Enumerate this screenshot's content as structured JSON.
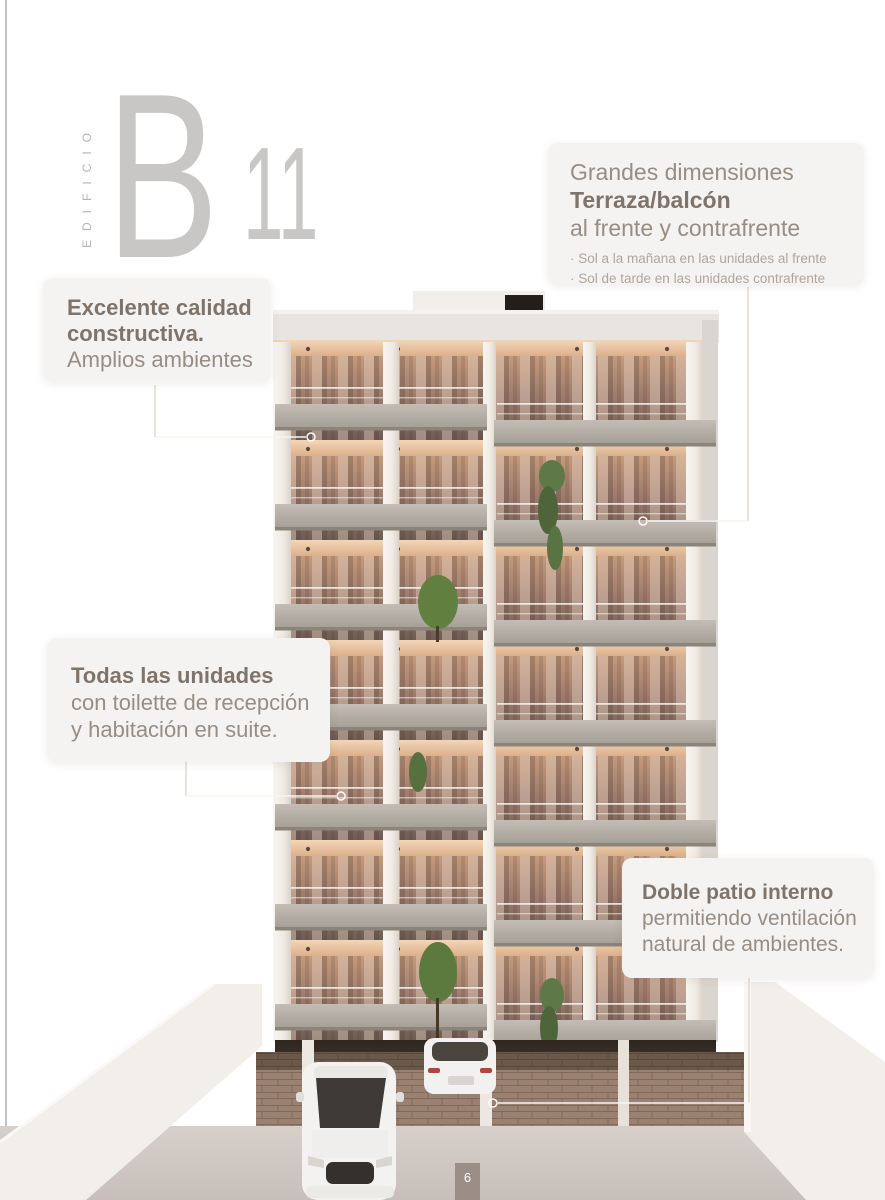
{
  "page": {
    "number": "6"
  },
  "logo": {
    "vertical_label": "EDIFICIO",
    "letter": "B",
    "number": "11"
  },
  "callouts": {
    "dimensions": {
      "line1": "Grandes dimensiones",
      "line2": "Terraza/balcón",
      "line3": "al frente y contrafrente",
      "bullets": [
        "· Sol a la mañana en las unidades al frente",
        "· Sol de tarde en las unidades contrafrente"
      ]
    },
    "quality": {
      "bold1": "Excelente calidad",
      "bold2": "constructiva.",
      "line3": "Amplios ambientes"
    },
    "units": {
      "bold": "Todas las unidades",
      "line2": "con toilette de recepción",
      "line3": "y habitación en suite."
    },
    "patio": {
      "bold": "Doble patio interno",
      "line2": "permitiendo ventilación",
      "line3": "natural de ambientes."
    }
  },
  "colors": {
    "heading_bold": "#7f746b",
    "heading_regular": "#978d85",
    "bullet_text": "#b0a59c",
    "logo_gray": "#c9c7c5",
    "page_tab": "#9b8e86"
  }
}
